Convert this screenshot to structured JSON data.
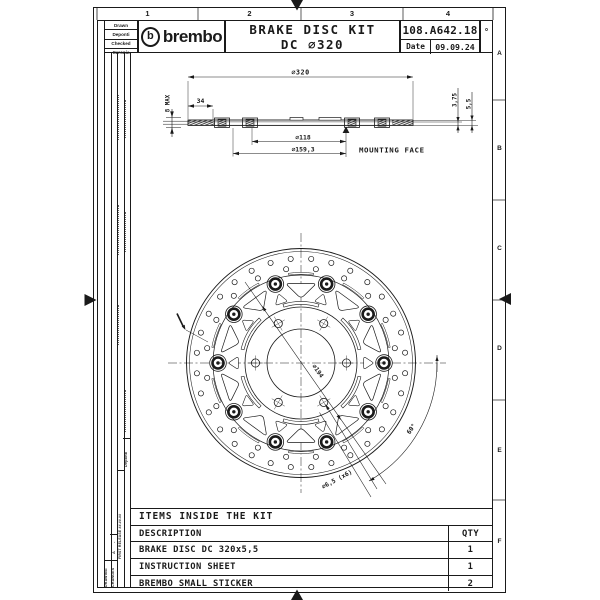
{
  "sheet": {
    "zones_top": [
      "1",
      "2",
      "3",
      "4"
    ],
    "zones_right": [
      "A",
      "B",
      "C",
      "D",
      "E",
      "F"
    ],
    "format_mark": "o"
  },
  "title_block": {
    "signatures": [
      "Drawn",
      "Deponti",
      "Checked",
      "Caronia"
    ],
    "brand_mark": "b",
    "brand": "brembo",
    "title_line1": "BRAKE DISC KIT",
    "title_line2": "DC ∅320",
    "part_number": "108.A642.18",
    "date_label": "Date",
    "date_value": "09.09.24"
  },
  "revision_strip": {
    "col1": "DRAWING",
    "col2": "CHANGES",
    "rev_letter": "A",
    "rev_dash": "-",
    "release_note": "FIRST RELEASE ##.##.##",
    "signer": "Deponti"
  },
  "side_view": {
    "dia_overall": "∅320",
    "dim_34": "34",
    "dim_8max": "8 MAX",
    "dia_118": "∅118",
    "dia_159": "∅159,3",
    "dim_375": "3,75",
    "dim_55": "5,5",
    "mounting_face": "MOUNTING FACE"
  },
  "front_view": {
    "dia_194": "∅194",
    "angle_60": "60°",
    "holes": "∅6,5 (x6)"
  },
  "kit_table": {
    "title": "ITEMS INSIDE THE KIT",
    "col_description": "DESCRIPTION",
    "col_qty": "QTY",
    "rows": [
      {
        "description": "BRAKE DISC DC 320x5,5",
        "qty": "1"
      },
      {
        "description": "INSTRUCTION SHEET",
        "qty": "1"
      },
      {
        "description": "BREMBO SMALL STICKER",
        "qty": "2"
      }
    ]
  },
  "colors": {
    "line": "#1a1a1a",
    "background": "#ffffff"
  }
}
